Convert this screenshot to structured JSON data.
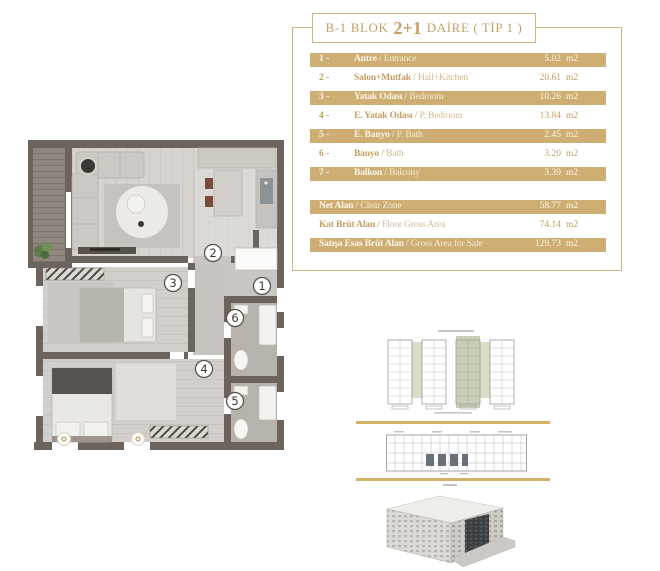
{
  "header": {
    "block": "B-1 BLOK",
    "type": "2+1",
    "suffix": "DAİRE ( TİP 1 )"
  },
  "sep": "/",
  "rooms": [
    {
      "num": "1 -",
      "tr": "Antre",
      "en": "Entrance",
      "area": "5.02",
      "unit": "m2",
      "highlight": true
    },
    {
      "num": "2 -",
      "tr": "Salon+Mutfak",
      "en": "Hall+Kitchen",
      "area": "20.61",
      "unit": "m2",
      "highlight": false
    },
    {
      "num": "3 -",
      "tr": "Yatak Odası",
      "en": "Bedroom",
      "area": "10.26",
      "unit": "m2",
      "highlight": true
    },
    {
      "num": "4 -",
      "tr": "E. Yatak Odası",
      "en": "P. Bedroom",
      "area": "13.84",
      "unit": "m2",
      "highlight": false
    },
    {
      "num": "5 -",
      "tr": "E. Banyo",
      "en": "P. Bath",
      "area": "2.45",
      "unit": "m2",
      "highlight": true
    },
    {
      "num": "6 -",
      "tr": "Banyo",
      "en": "Bath",
      "area": "3.20",
      "unit": "m2",
      "highlight": false
    },
    {
      "num": "7 -",
      "tr": "Balkon",
      "en": "Balcony",
      "area": "3.39",
      "unit": "m2",
      "highlight": true
    }
  ],
  "totals": [
    {
      "tr": "Net Alan",
      "en": "Clear Zone",
      "area": "58.77",
      "unit": "m2",
      "highlight": true
    },
    {
      "tr": "Kat Brüt Alan",
      "en": "Floor Gross Area",
      "area": "74.14",
      "unit": "m2",
      "highlight": false
    },
    {
      "tr": "Satışa Esas Brüt Alan",
      "en": "Gross Area for Sale",
      "area": "129.73",
      "unit": "m2",
      "highlight": true
    }
  ],
  "plan": {
    "labels": {
      "antre": "1",
      "salon": "2",
      "yatak": "3",
      "ebeveyn_yatak": "4",
      "ebeveyn_banyo": "5",
      "banyo": "6"
    }
  },
  "colors": {
    "gold_text": "#c5a167",
    "tan_row": "#cfae74",
    "frame_border": "#cdb284",
    "separator_line": "#d3b166",
    "wall": "#6b635c"
  }
}
